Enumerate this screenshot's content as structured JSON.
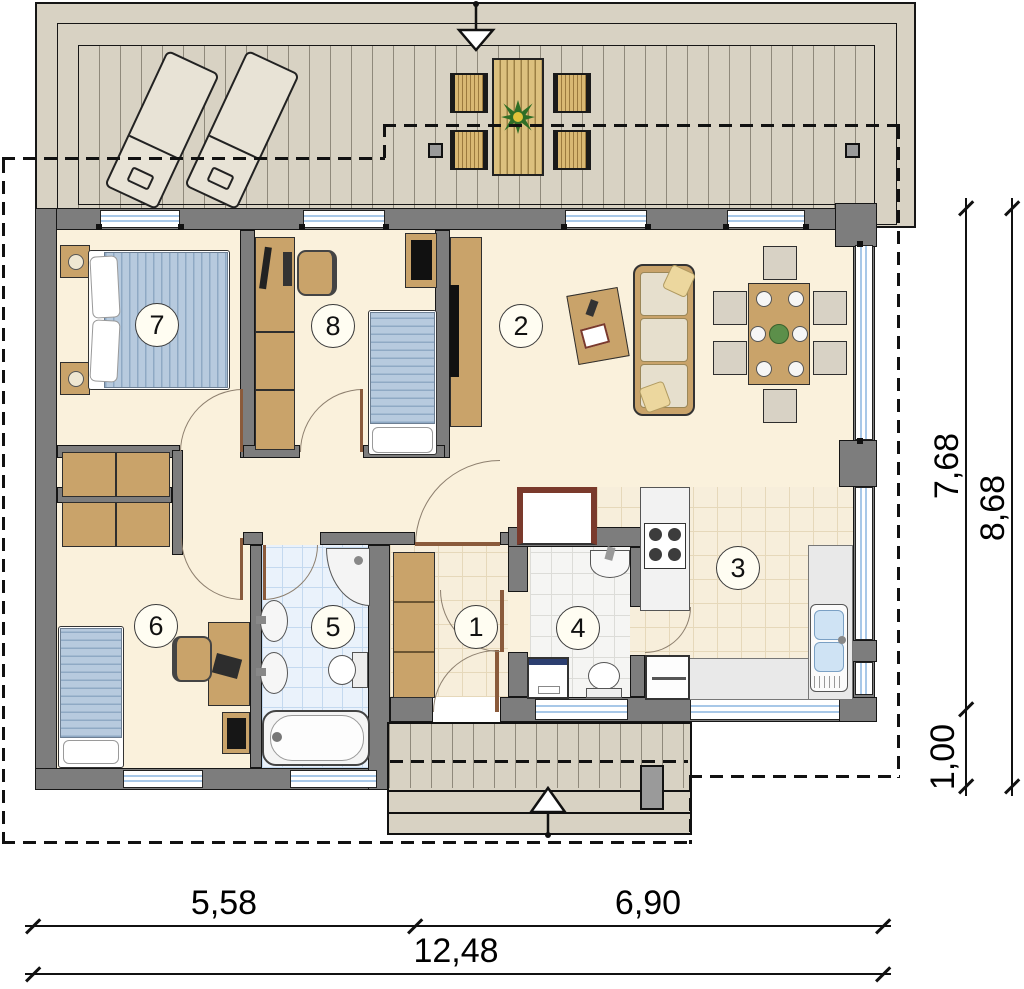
{
  "plan": {
    "rooms": [
      {
        "number": "1"
      },
      {
        "number": "2"
      },
      {
        "number": "3"
      },
      {
        "number": "4"
      },
      {
        "number": "5"
      },
      {
        "number": "6"
      },
      {
        "number": "7"
      },
      {
        "number": "8"
      }
    ],
    "dimensions": {
      "width_left": "5,58",
      "width_right": "6,90",
      "width_total": "12,48",
      "depth_main": "7,68",
      "depth_extension": "1,00",
      "depth_total": "8,68"
    },
    "colors": {
      "wall": "#7d7d7d",
      "deck": "#d8d2c3",
      "room_floor": "#faf1dc",
      "bath_tile": "#eaf2fb",
      "furniture_wood": "#c9a36a",
      "bedding": "#b7cade",
      "door_leaf": "#8a5a3b",
      "glazing": "#a8c8e8"
    }
  }
}
